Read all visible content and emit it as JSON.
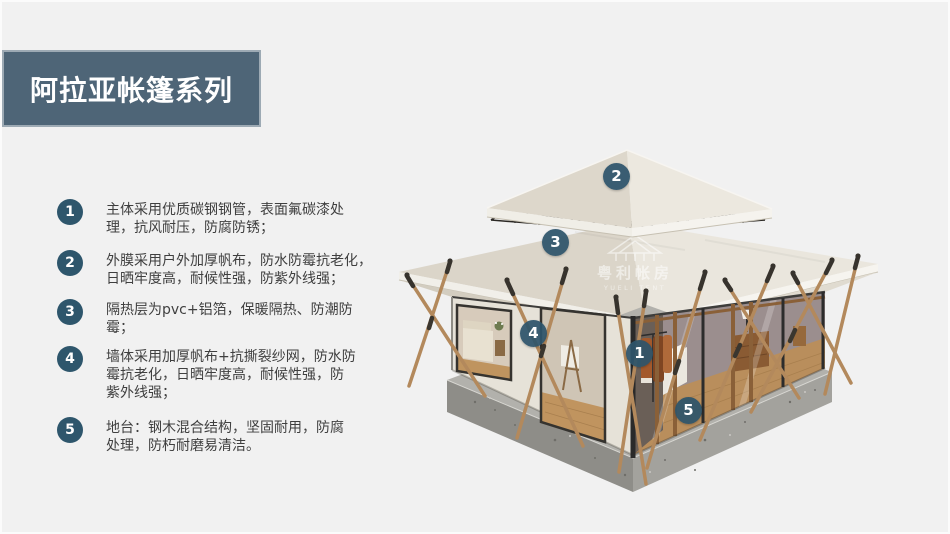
{
  "title": {
    "text": "阿拉亚帐篷系列"
  },
  "features": [
    {
      "num": "1",
      "text": "主体采用优质碳钢钢管，表面氟碳漆处\n理，抗风耐压，防腐防锈；"
    },
    {
      "num": "2",
      "text": "外膜采用户外加厚帆布，防水防霉抗老化，\n日晒牢度高，耐候性强，防紫外线强；"
    },
    {
      "num": "3",
      "text": "隔热层为pvc+铝箔，保暖隔热、防潮防\n霉；"
    },
    {
      "num": "4",
      "text": "墙体采用加厚帆布+抗撕裂纱网，防水防\n霉抗老化，日晒牢度高，耐候性强，防\n紫外线强；"
    },
    {
      "num": "5",
      "text": "地台：钢木混合结构，坚固耐用，防腐\n处理，防朽耐磨易清洁。"
    }
  ],
  "callouts": [
    {
      "num": "1"
    },
    {
      "num": "2"
    },
    {
      "num": "3"
    },
    {
      "num": "4"
    },
    {
      "num": "5"
    }
  ],
  "watermark": {
    "cn": "粤利帐房",
    "en": "YUELI TENT"
  },
  "colors": {
    "bg": "#f1f1f1",
    "banner": "#4e6577",
    "badge": "#2e566c",
    "text": "#3f3f3f"
  }
}
